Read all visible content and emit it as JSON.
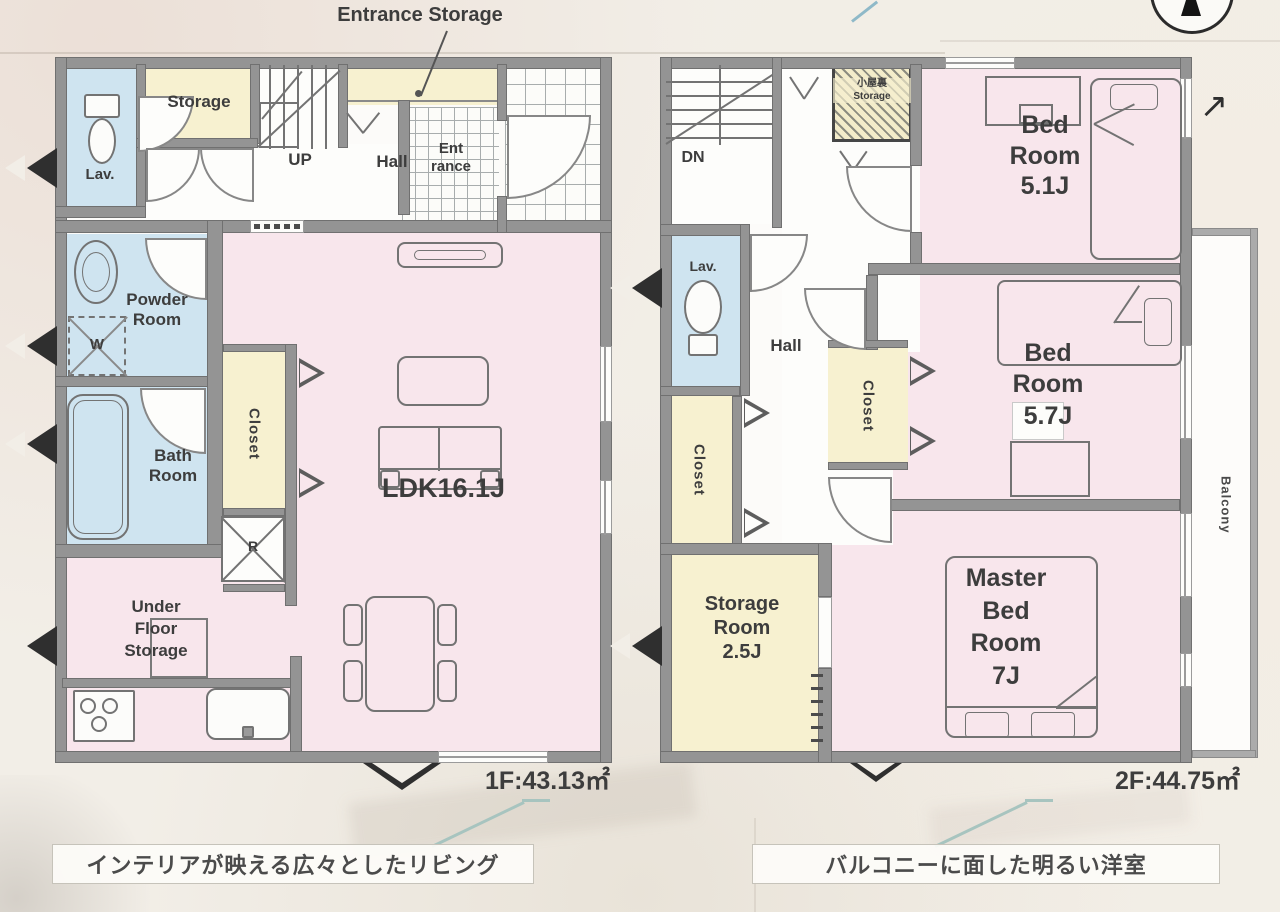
{
  "colors": {
    "background": "#f2eee7",
    "wall": "#949494",
    "room_pink": "#f8e6ec",
    "room_blue": "#cfe4f0",
    "room_yellow": "#f7f1d0",
    "furniture_line": "#737373",
    "text": "#3d3d3d",
    "leader_teal": "#a7c4bf"
  },
  "floor1": {
    "annotation_entrance_storage": "Entrance Storage",
    "rooms": {
      "lav": "Lav.",
      "storage": "Storage",
      "stairs_up": "UP",
      "hall": "Hall",
      "entrance": "Ent\nrance",
      "powder_room": "Powder\nRoom",
      "washer": "W",
      "bath_room": "Bath\nRoom",
      "closet": "Closet",
      "refrigerator": "R",
      "under_floor_storage": "Under\nFloor\nStorage",
      "ldk": "LDK16.1J"
    },
    "area_label": "1F:43.13㎡",
    "caption": "インテリアが映える広々としたリビング"
  },
  "floor2": {
    "rooms": {
      "stairs_down": "DN",
      "attic_storage": "小屋裏\nStorage",
      "bedroom1": "Bed\nRoom\n5.1J",
      "lav": "Lav.",
      "hall": "Hall",
      "closet_west": "Closet",
      "closet_center": "Closet",
      "bedroom2": "Bed\nRoom\n5.7J",
      "storage_room": "Storage\nRoom\n2.5J",
      "master_bedroom": "Master\nBed\nRoom\n7J",
      "balcony": "Balcony"
    },
    "area_label": "2F:44.75㎡",
    "caption": "バルコニーに面した明るい洋室"
  },
  "icons": {
    "ne_arrow": "↗"
  }
}
